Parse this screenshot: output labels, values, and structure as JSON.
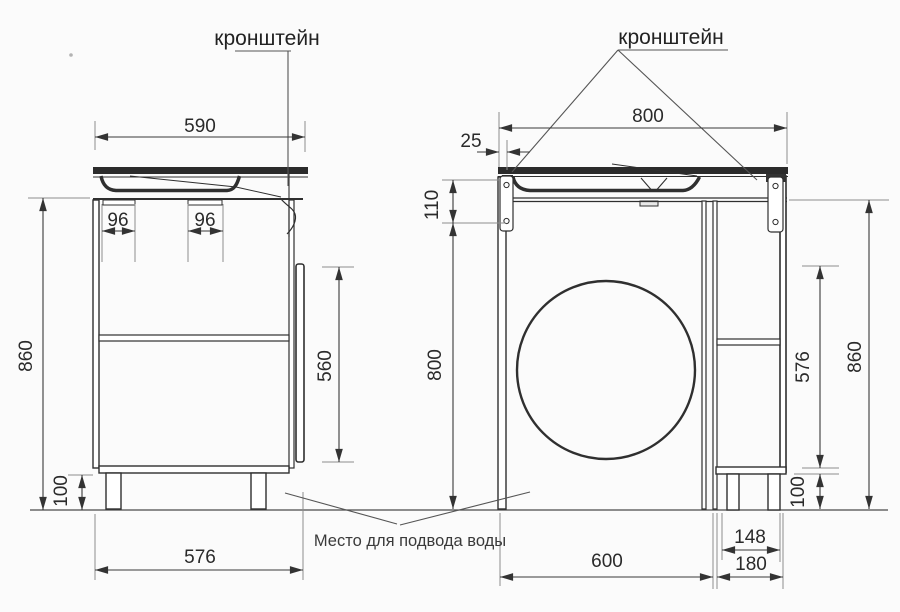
{
  "annotations": {
    "bracket_label_left": "кронштейн",
    "bracket_label_right": "кронштейн",
    "water_supply_note": "Место для подвода воды"
  },
  "left_cabinet": {
    "dims": {
      "top_width": "590",
      "rail_spacing_left": "96",
      "rail_spacing_right": "96",
      "total_height": "860",
      "door_height": "560",
      "leg_height": "100",
      "body_width": "576"
    }
  },
  "right_cabinet": {
    "dims": {
      "top_width": "800",
      "panel_thickness": "25",
      "apron_height": "110",
      "niche_height": "800",
      "total_height": "860",
      "side_door_height": "576",
      "leg_height": "100",
      "side_inner_width": "148",
      "side_outer_width": "180",
      "niche_width": "600"
    }
  },
  "colors": {
    "line": "#2f2f2f",
    "dimension": "#3a3a3a",
    "extension": "#8d8d8d",
    "background": "#fbfbfb"
  }
}
